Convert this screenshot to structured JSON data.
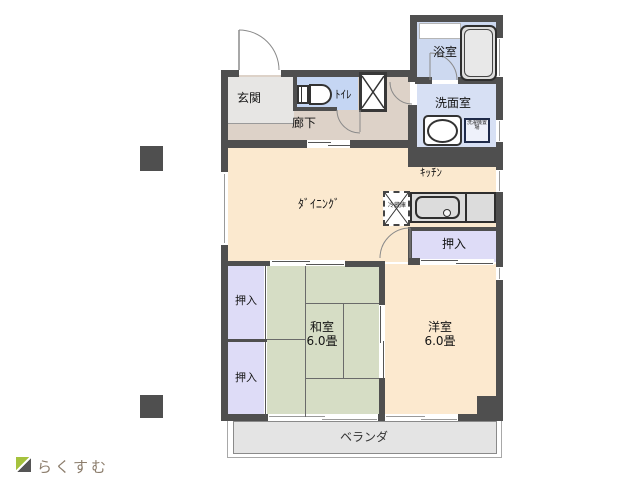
{
  "brand": {
    "name": "らくすむ"
  },
  "rooms": {
    "genkan": "玄関",
    "toilet": "ﾄｲﾚ",
    "hallway": "廊下",
    "bathroom": "浴室",
    "washroom": "洗面室",
    "dining": "ﾀﾞｲﾆﾝｸﾞ",
    "kitchen": "ｷｯﾁﾝ",
    "closet": "押入",
    "japanese_room": {
      "name": "和室",
      "size": "6.0畳"
    },
    "western_room": {
      "name": "洋室",
      "size": "6.0畳"
    },
    "veranda": "ベランダ"
  },
  "fixtures": {
    "refrigerator_note": "冷蔵庫",
    "washer_note": "洗濯機置場"
  },
  "colors": {
    "wall": "#4f4f4f",
    "dining_western": "#fbe9cf",
    "tatami": "#d6ddc5",
    "closet": "#dedcf7",
    "wet_area": "#cdd9f0",
    "washroom": "#d7e0f4",
    "hallway": "#ddd2c8",
    "genkan": "#e7e6e4",
    "balcony": "#e4e4e4",
    "logo_green": "#a5c23d"
  }
}
